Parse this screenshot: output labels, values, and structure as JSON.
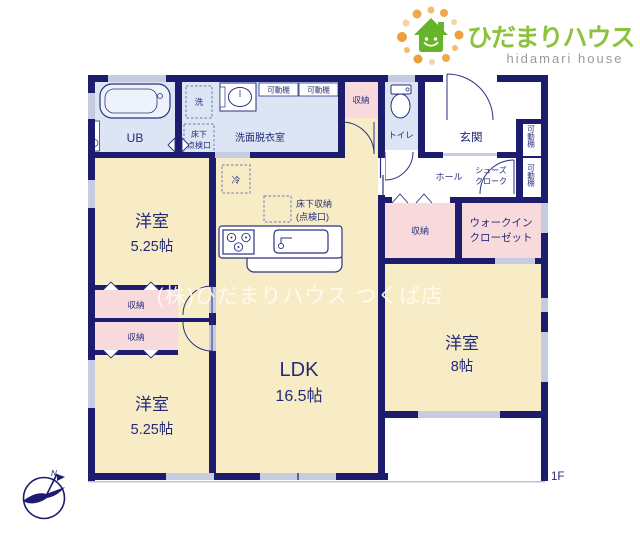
{
  "brand": {
    "name_jp": "ひだまりハウス",
    "name_en": "hidamari house",
    "green_text": "#8dc33c",
    "green_house": "#67b42a",
    "orange_dot": "#ec9f3a"
  },
  "plan": {
    "floor": "1F",
    "watermark": "(株)ひだまりハウス つくば店",
    "compass_n": "N",
    "colors": {
      "wall_navy": "#1c1d6e",
      "room_cream": "#f8ecc6",
      "room_blue": "#dbe5f3",
      "room_pink": "#f8dadc",
      "window_gray": "#c6cbe0"
    },
    "labels": {
      "ub": "UB",
      "washer": "洗",
      "hatch1": "床下",
      "hatch2": "点検口",
      "laundry": "洗面脱衣室",
      "shelf": "可動棚",
      "storage": "収納",
      "toilet": "トイレ",
      "entrance": "玄関",
      "hall": "ホール",
      "shoes1": "シューズ",
      "shoes2": "クローク",
      "wic1": "ウォークイン",
      "wic2": "クローゼット",
      "fridge": "冷",
      "ufs1": "床下収納",
      "ufs2": "(点検口)",
      "western": "洋室",
      "s525": "5.25帖",
      "ldk": "LDK",
      "s165": "16.5帖",
      "s8": "8帖"
    }
  }
}
